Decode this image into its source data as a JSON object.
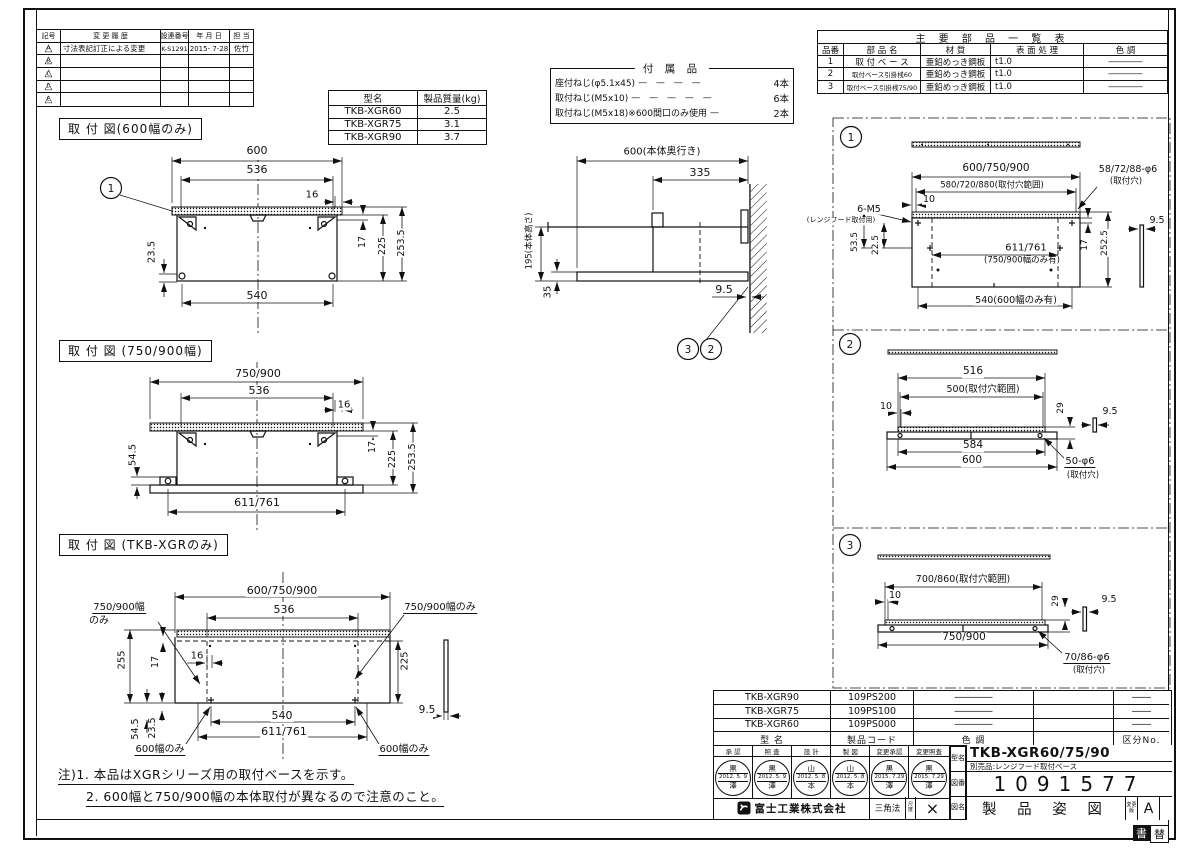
{
  "revision_table": {
    "headers": [
      "記号",
      "変 更 履 歴",
      "設連番号",
      "年 月 日",
      "担 当"
    ],
    "rows": [
      {
        "mark": "A",
        "desc": "寸法表記訂正による変更",
        "no": "K-S1291",
        "date": "2015- 7-28",
        "by": "佐竹"
      },
      {
        "mark": "B",
        "desc": "",
        "no": "",
        "date": "",
        "by": ""
      },
      {
        "mark": "C",
        "desc": "",
        "no": "",
        "date": "",
        "by": ""
      },
      {
        "mark": "D",
        "desc": "",
        "no": "",
        "date": "",
        "by": ""
      },
      {
        "mark": "E",
        "desc": "",
        "no": "",
        "date": "",
        "by": ""
      }
    ]
  },
  "parts_table": {
    "title": "主  要  部  品  一  覧  表",
    "headers": [
      "品番",
      "部 品 名",
      "材  質",
      "表 面 処 理",
      "色   調"
    ],
    "rows": [
      [
        "1",
        "取 付 ベ ー ス",
        "亜鉛めっき鋼板",
        "t1.0",
        "――――"
      ],
      [
        "2",
        "取付ベース引掛桟60",
        "亜鉛めっき鋼板",
        "t1.0",
        "――――"
      ],
      [
        "3",
        "取付ベース引掛桟75/90",
        "亜鉛めっき鋼板",
        "t1.0",
        "――――"
      ]
    ]
  },
  "model_table": {
    "headers": [
      "型名",
      "製品質量(kg)"
    ],
    "rows": [
      [
        "TKB-XGR60",
        "2.5"
      ],
      [
        "TKB-XGR75",
        "3.1"
      ],
      [
        "TKB-XGR90",
        "3.7"
      ]
    ]
  },
  "accessories": {
    "title": "付 属 品",
    "items": [
      {
        "name": "座付ねじ(φ5.1x45)",
        "dash": "— — — —",
        "qty": "4本"
      },
      {
        "name": "取付ねじ(M5x10)",
        "dash": "— — — — —",
        "qty": "6本"
      },
      {
        "name": "取付ねじ(M5x18)※600間口のみ使用",
        "dash": "—",
        "qty": "2本"
      }
    ]
  },
  "titles": {
    "d600": "取 付 図(600幅のみ)",
    "d7590": "取 付 図 (750/900幅)",
    "dxgr": "取 付 図 (TKB-XGRのみ)"
  },
  "notes": {
    "n1": "注)1. 本品はXGRシリーズ用の取付ベースを示す。",
    "n2": "2. 600幅と750/900幅の本体取付が異なるので注意のこと。"
  },
  "balloons": {
    "b1": "1",
    "b2": "2",
    "b3": "3"
  },
  "dims": {
    "d1_600": "600",
    "d1_536": "536",
    "d1_16": "16",
    "d1_23_5": "23.5",
    "d1_540": "540",
    "d1_17": "17",
    "d1_225": "225",
    "d1_253_5": "253.5",
    "sv_600": "600(本体奥行き)",
    "sv_335": "335",
    "sv_195": "195(本体高さ)",
    "sv_35": "35",
    "sv_9_5": "9.5",
    "d2_750900": "750/900",
    "d2_536": "536",
    "d2_16": "16",
    "d2_54_5": "54.5",
    "d2_611": "611/761",
    "d2_17": "17",
    "d2_225": "225",
    "d2_253_5": "253.5",
    "d3_600750900": "600/750/900",
    "d3_536": "536",
    "d3_lbl_l1": "750/900幅",
    "d3_lbl_l2": "のみ",
    "d3_lbl_r": "750/900幅のみ",
    "d3_255": "255",
    "d3_17": "17",
    "d3_16": "16",
    "d3_225": "225",
    "d3_54_5": "54.5",
    "d3_23_5": "23.5",
    "d3_540": "540",
    "d3_611": "611/761",
    "d3_bl": "600幅のみ",
    "d3_br": "600幅のみ",
    "d3_9_5": "9.5",
    "p1_600750900": "600/750/900",
    "p1_580": "580/720/880(取付穴範囲)",
    "p1_hole": "58/72/88-φ6",
    "p1_hole2": "(取付穴)",
    "p1_10": "10",
    "p1_6m5": "6-M5",
    "p1_6m5b": "(レンジフード取付用)",
    "p1_53_5": "53.5",
    "p1_22_5": "22.5",
    "p1_611": "611/761",
    "p1_611b": "(750/900幅のみ有)",
    "p1_17": "17",
    "p1_252_5": "252.5",
    "p1_540": "540(600幅のみ有)",
    "p1_9_5": "9.5",
    "p2_516": "516",
    "p2_500": "500(取付穴範囲)",
    "p2_10": "10",
    "p2_584": "584",
    "p2_600": "600",
    "p2_29": "29",
    "p2_9_5": "9.5",
    "p2_hole": "50-φ6",
    "p2_hole2": "(取付穴)",
    "p3_700860": "700/860(取付穴範囲)",
    "p3_10": "10",
    "p3_750900": "750/900",
    "p3_29": "29",
    "p3_9_5": "9.5",
    "p3_hole": "70/86-φ6",
    "p3_hole2": "(取付穴)"
  },
  "title_block": {
    "models": [
      [
        "TKB-XGR90",
        "109PS200",
        "――――",
        "",
        "――"
      ],
      [
        "TKB-XGR75",
        "109PS100",
        "――――",
        "",
        "――"
      ],
      [
        "TKB-XGR60",
        "109PS000",
        "――――",
        "",
        "――"
      ]
    ],
    "model_headers": [
      "型   名",
      "製品コード",
      "色   調",
      "",
      "区分No."
    ],
    "approval_headers": [
      "承 認",
      "照 査",
      "設 計",
      "製 図",
      "変更承認",
      "変更照査"
    ],
    "stamps": [
      {
        "t": "黒",
        "d": "2012. 5. 9",
        "b": "澤"
      },
      {
        "t": "黒",
        "d": "2012. 5. 9",
        "b": "澤"
      },
      {
        "t": "山",
        "d": "2012. 5. 8",
        "b": "本"
      },
      {
        "t": "山",
        "d": "2012. 5. 8",
        "b": "本"
      },
      {
        "t": "黒",
        "d": "2015. 7.29",
        "b": "澤"
      },
      {
        "t": "黒",
        "d": "2015. 7.29",
        "b": "澤"
      }
    ],
    "side_labels": {
      "model": "型名",
      "number": "図番",
      "name": "図名"
    },
    "model_value": "TKB-XGR60/75/90",
    "subtitle": "別売品:レンジフード取付ベース",
    "drawing_number": "1091577",
    "drawing_name": "製 品 姿 図",
    "rev_label": "変更版",
    "rev_value": "A",
    "company": "富士工業株式会社",
    "projection": "三角法",
    "scale_label": "尺度",
    "scale_value": "×",
    "rewrite1": "書",
    "rewrite2": "替"
  }
}
